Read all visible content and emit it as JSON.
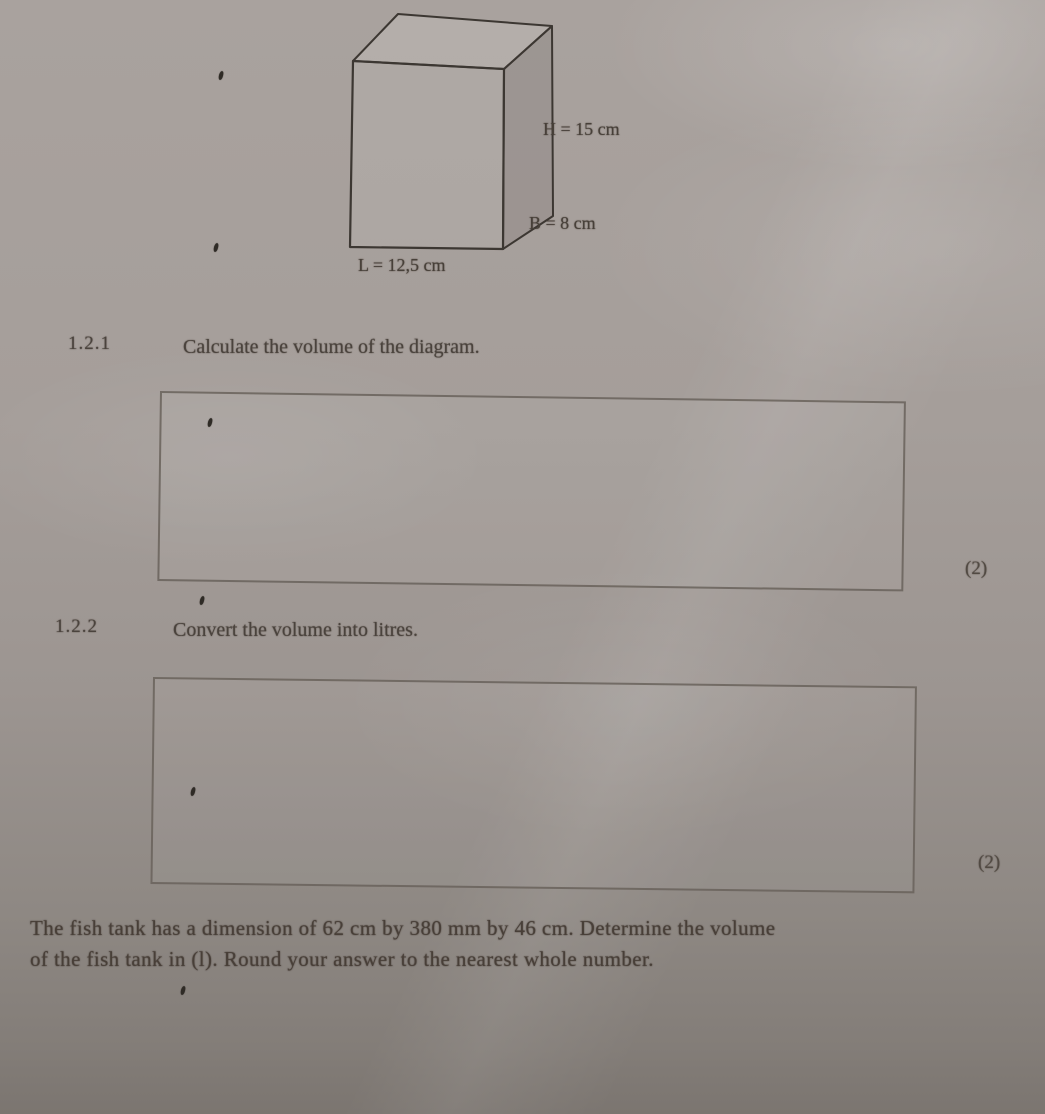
{
  "diagram": {
    "shape": "rectangular-prism",
    "labels": {
      "height": "H = 15 cm",
      "breadth": "B = 8 cm",
      "length": "L = 12,5 cm"
    }
  },
  "questions": [
    {
      "number": "1.2.1",
      "text": "Calculate the volume of the diagram.",
      "marks": "(2)"
    },
    {
      "number": "1.2.2",
      "text": "Convert the volume into litres.",
      "marks": "(2)"
    }
  ],
  "footer": {
    "lines": [
      "The fish tank has a dimension of 62 cm by 380 mm by 46 cm. Determine the volume",
      "of the fish tank in (l). Round your answer to the nearest whole number."
    ]
  },
  "colors": {
    "paper_light": "#a9a29e",
    "paper_dark": "#7b7570",
    "ink": "#4a433d",
    "line": "#68615a"
  }
}
